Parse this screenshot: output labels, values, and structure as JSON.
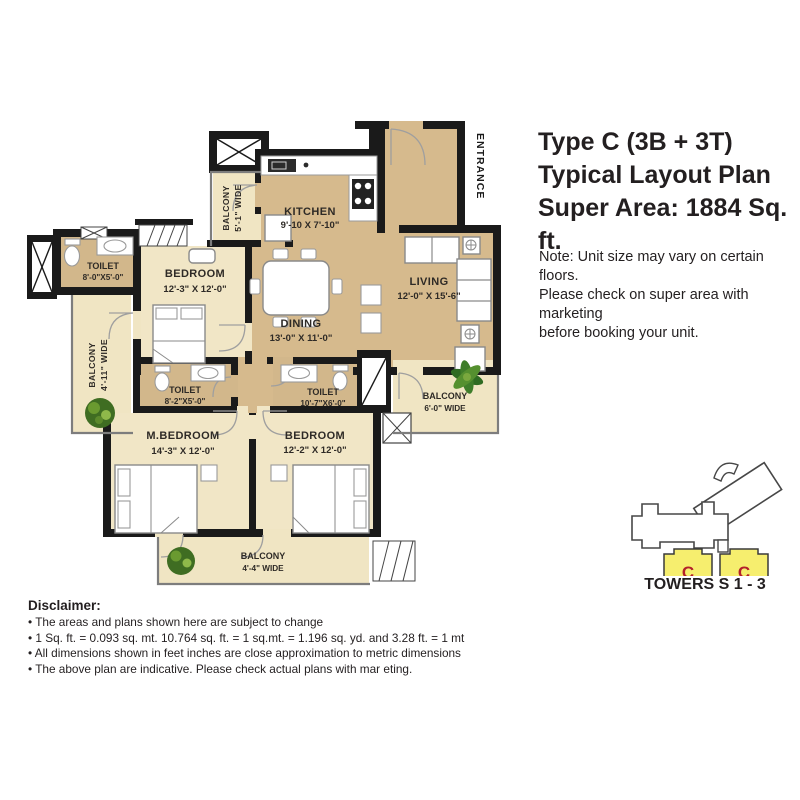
{
  "title": {
    "line1": "Type C (3B + 3T)",
    "line2": "Typical Layout Plan",
    "line3": "Super Area: 1884 Sq. ft."
  },
  "note": {
    "line1": "Note: Unit size may vary on certain floors.",
    "line2": "Please check on super area with marketing",
    "line3": "before booking your unit."
  },
  "disclaimer": {
    "heading": "Disclaimer:",
    "bullets": [
      "• The areas and plans shown here are subject to change",
      "• 1 Sq. ft. = 0.093 sq. mt. 10.764 sq. ft. = 1 sq.mt. = 1.196 sq. yd. and 3.28 ft. = 1 mt",
      "• All dimensions shown in feet inches are close approximation to metric dimensions",
      "• The above plan are indicative. Please check actual plans with mar eting."
    ]
  },
  "rooms": {
    "kitchen": {
      "name": "KITCHEN",
      "dims": "9'-10 X 7'-10\""
    },
    "living": {
      "name": "LIVING",
      "dims": "12'-0\" X 15'-6\""
    },
    "dining": {
      "name": "DINING",
      "dims": "13'-0\" X 11'-0\""
    },
    "bedroom_top": {
      "name": "BEDROOM",
      "dims": "12'-3\" X 12'-0\""
    },
    "m_bedroom": {
      "name": "M.BEDROOM",
      "dims": "14'-3\" X 12'-0\""
    },
    "bedroom_bottom": {
      "name": "BEDROOM",
      "dims": "12'-2\" X 12'-0\""
    },
    "toilet_left": {
      "name": "TOILET",
      "dims": "8'-0\"X5'-0\""
    },
    "toilet_mid": {
      "name": "TOILET",
      "dims": "8'-2\"X5'-0\""
    },
    "toilet_right": {
      "name": "TOILET",
      "dims": "10'-7\"X6'-0\""
    },
    "balcony_kitchen": {
      "name": "BALCONY",
      "dims": "5'-1\" WIDE"
    },
    "balcony_left": {
      "name": "BALCONY",
      "dims": "4'-11\" WIDE"
    },
    "balcony_right": {
      "name": "BALCONY",
      "dims": "6'-0\" WIDE"
    },
    "balcony_bottom": {
      "name": "BALCONY",
      "dims": "4'-4\" WIDE"
    },
    "entrance": {
      "name": "ENTRANCE"
    }
  },
  "tower_inset": {
    "caption": "TOWERS S 1 - 3",
    "unit_labels": [
      "C",
      "C"
    ],
    "highlight_color": "#f6ee6e",
    "label_color": "#b3202a"
  },
  "colors": {
    "wall": "#1a1a1a",
    "floor_tan": "#d6ba8d",
    "floor_cream": "#f1e6c6",
    "plant_green": "#4e7c28"
  }
}
